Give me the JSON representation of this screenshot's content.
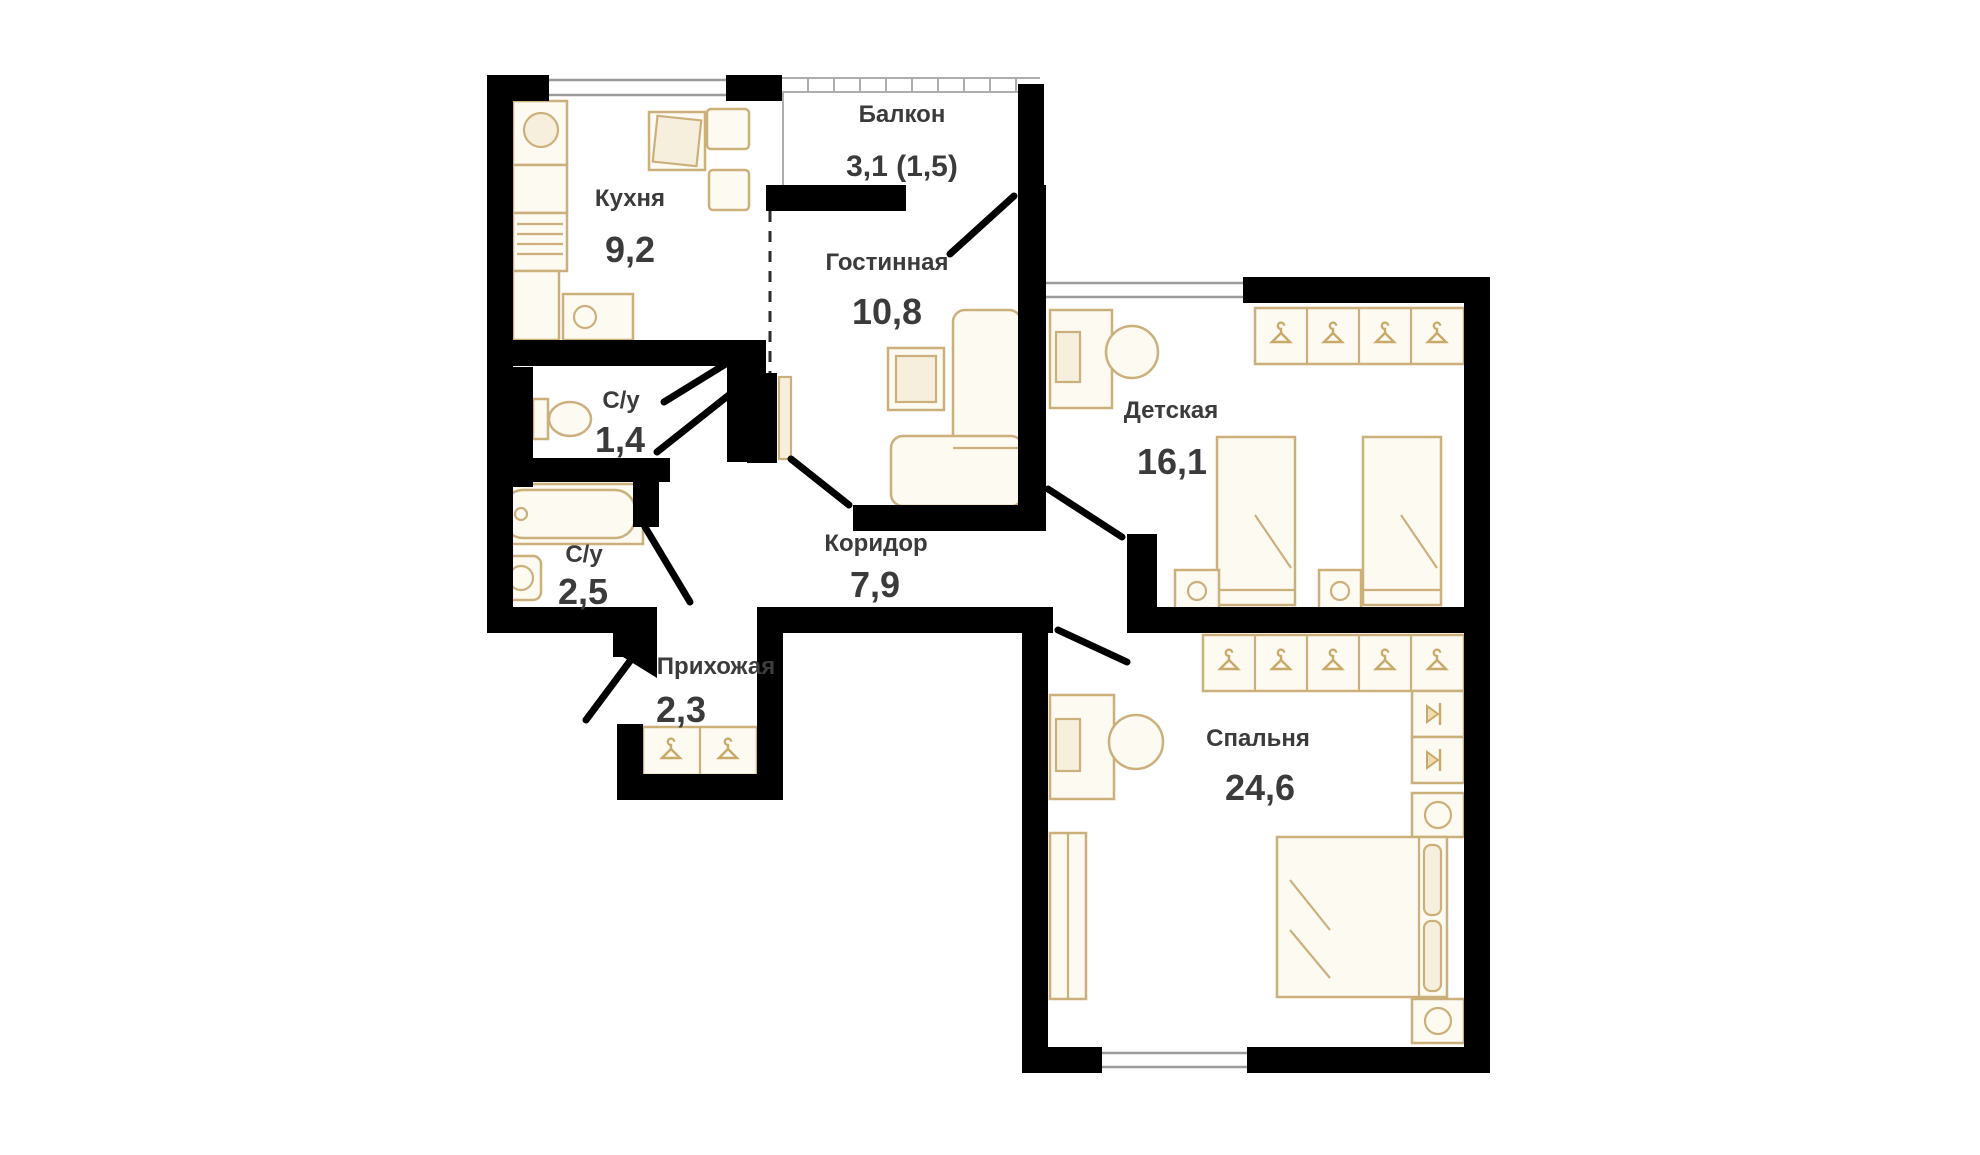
{
  "plan": {
    "title": "apartment-floor-plan",
    "rooms": [
      {
        "id": "kitchen",
        "name": "Кухня",
        "area": "9,2"
      },
      {
        "id": "balcony",
        "name": "Балкон",
        "area": "3,1 (1,5)"
      },
      {
        "id": "living",
        "name": "Гостинная",
        "area": "10,8"
      },
      {
        "id": "bath-small",
        "name": "С/у",
        "area": "1,4"
      },
      {
        "id": "bath-big",
        "name": "С/у",
        "area": "2,5"
      },
      {
        "id": "corridor",
        "name": "Коридор",
        "area": "7,9"
      },
      {
        "id": "hallway",
        "name": "Прихожая",
        "area": "2,3"
      },
      {
        "id": "children",
        "name": "Детская",
        "area": "16,1"
      },
      {
        "id": "bedroom",
        "name": "Спальня",
        "area": "24,6"
      }
    ],
    "palette": {
      "wall": "#000000",
      "furniture": "#ccb07c",
      "label": "#3b3b3b",
      "window": "#9b9b9b",
      "background": "#ffffff"
    },
    "icons": {
      "hanger": "clothes-hanger-glyph",
      "hook": "wall-hook-glyph"
    }
  }
}
